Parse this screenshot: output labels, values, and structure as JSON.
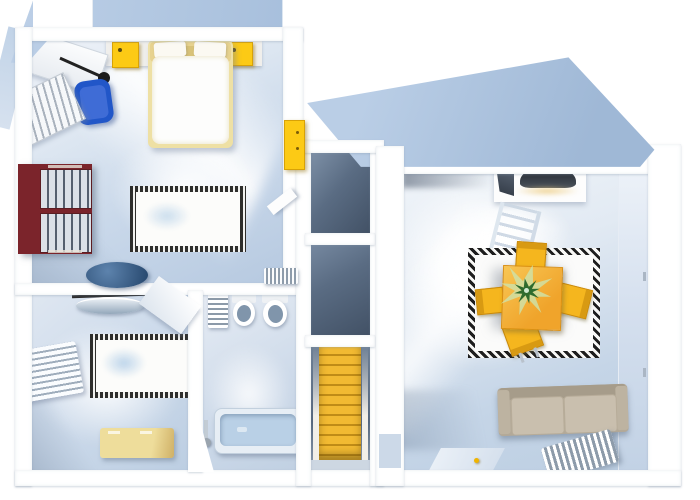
{
  "scene": {
    "type": "3d-floorplan-top-view",
    "description": "3D rendered top-down floor plan of an apartment upper floor, no visible text",
    "rooms": [
      {
        "id": "bedroom",
        "label": "Bedroom",
        "furniture": [
          "double bed with white duvet",
          "yellow nightstand left",
          "yellow nightstand right",
          "headboard shelf",
          "white desk with black lamp",
          "blue office chair",
          "book shelf",
          "maroon slatted wardrobe",
          "patterned rug",
          "yellow wall cabinet",
          "dark blue washbasin bowl",
          "open door"
        ]
      },
      {
        "id": "second-room",
        "label": "Second room",
        "furniture": [
          "glass wall basin with towel rail",
          "patterned rug",
          "white wall radiator shelf",
          "pale yellow storage bench",
          "open door"
        ]
      },
      {
        "id": "bathroom",
        "label": "Bathroom",
        "furniture": [
          "towel radiator",
          "toilet",
          "bidet",
          "small wall radiator",
          "blue bathtub with shower mixer",
          "angled wall"
        ]
      },
      {
        "id": "stairwell",
        "label": "Stairwell",
        "furniture": [
          "upper dark landing",
          "lower dark landing",
          "yellow staircase"
        ]
      },
      {
        "id": "living-room",
        "label": "Living / dining room",
        "furniture": [
          "cooker hood cabinet",
          "ladder-back chair",
          "greek-key bordered rug",
          "orange dining table",
          "green potted plant",
          "four yellow chairs",
          "taupe two-seat sofa",
          "finned radiator",
          "door mat with yellow handle"
        ]
      }
    ]
  },
  "palette": {
    "background": "#ffffff",
    "wall_white": "#ffffff",
    "roof_blue": "#aec4de",
    "floor_blue": "#cddbeb",
    "landing_slate": "#5a6c83",
    "stair_gold": "#eab42e",
    "accent_yellow": "#fcca15",
    "table_orange": "#f0a42b",
    "chair_yellow": "#f5b61e",
    "bed_cream": "#eee0a4",
    "armchair_blue": "#2156c8",
    "wardrobe_maroon": "#7b242b",
    "sofa_taupe": "#b3a998",
    "cushion_beige": "#c9bfae",
    "tub_blue": "#b9d0e6",
    "toilet_seat_blue": "#8095ab",
    "plant_green": "#2f6b2e",
    "handle_yellow": "#f0b400"
  }
}
